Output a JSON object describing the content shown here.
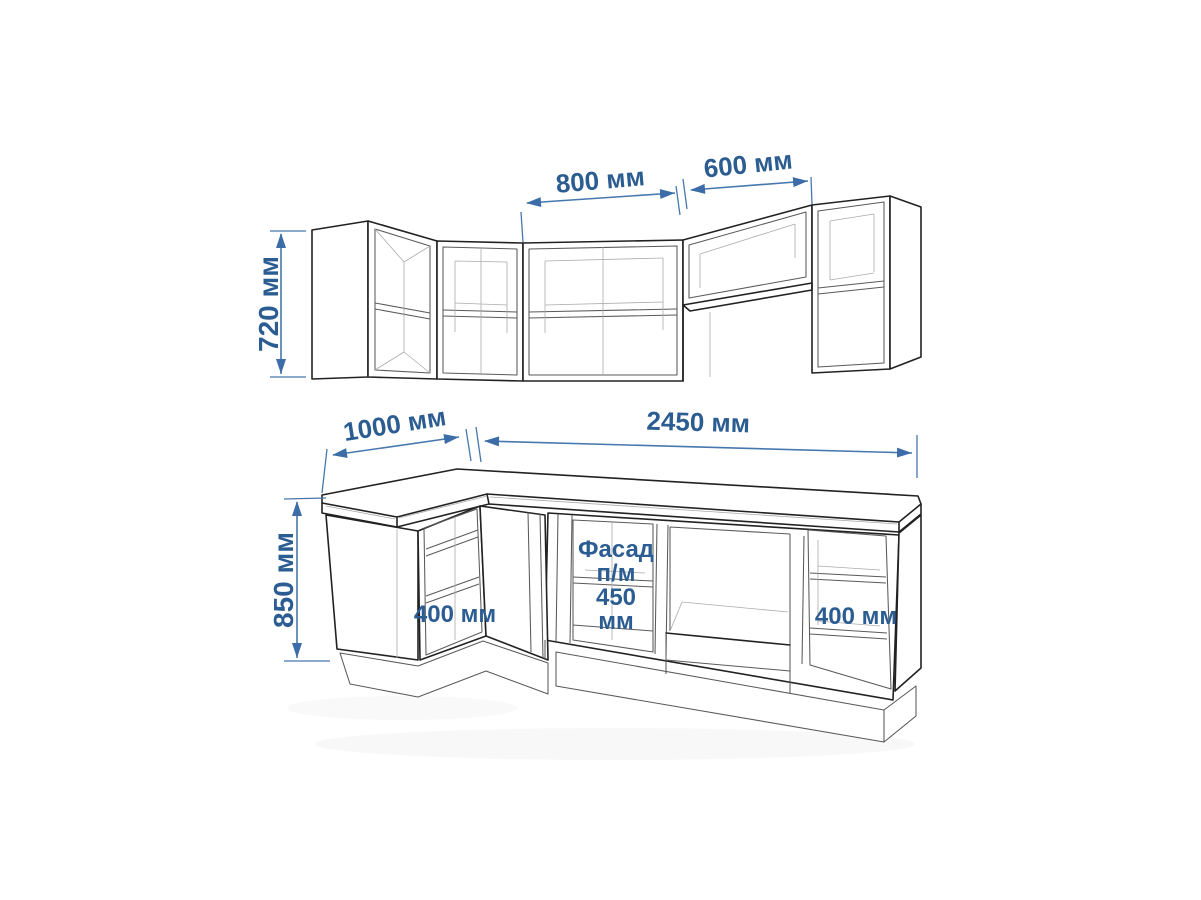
{
  "diagram": {
    "type": "kitchen-cabinet-dimension-drawing",
    "colors": {
      "dimension_text": "#2b5c92",
      "dimension_line": "#4678ad",
      "outline": "#222222"
    },
    "upper_row": {
      "height_label": "720 мм",
      "width_800_label": "800 мм",
      "width_600_label": "600 мм"
    },
    "base_row": {
      "depth_label": "1000 мм",
      "length_label": "2450 мм",
      "height_label": "850 мм",
      "left_shelf_label": "400 мм",
      "right_shelf_label": "400 мм",
      "facade_label_lines": [
        "Фасад",
        "п/м",
        "450",
        "мм"
      ]
    }
  }
}
